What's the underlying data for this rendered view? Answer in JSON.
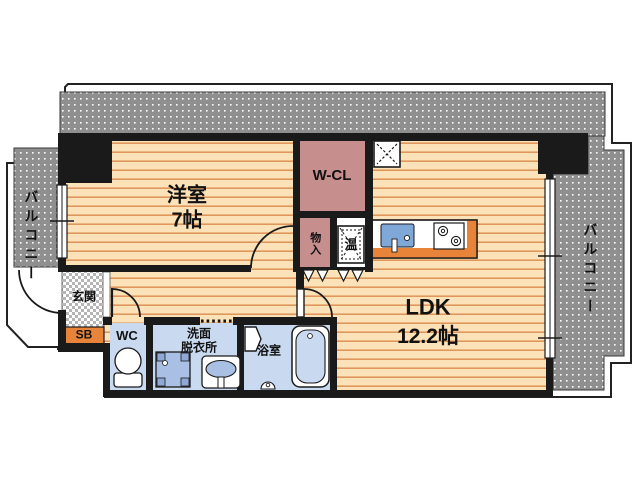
{
  "rooms": {
    "western_room": {
      "name": "洋室",
      "size": "7帖"
    },
    "walk_in_closet": {
      "name": "W-CL"
    },
    "ldk": {
      "name": "LDK",
      "size": "12.2帖"
    },
    "entrance": {
      "name": "玄関"
    },
    "shoe_box": {
      "name": "SB"
    },
    "toilet": {
      "name": "WC"
    },
    "washroom": {
      "line1": "洗面",
      "line2": "脱衣所"
    },
    "bathroom": {
      "name": "浴室"
    },
    "storage": {
      "name": "物入"
    },
    "water_heater": {
      "name": "温"
    },
    "balcony_left": {
      "name": "バルコニー"
    },
    "balcony_right": {
      "name": "バルコニー"
    }
  },
  "colors": {
    "wall": "#1a1a1a",
    "balcony_gray": "#8f8f8f",
    "floor_base": "#fbe2b9",
    "floor_line": "#e0975c",
    "closet_pink": "#c78e8e",
    "wet_room_blue": "#c9d9f0",
    "fixture_blue": "#a9c0e4",
    "accent_orange": "#e8843a",
    "outline_white": "#ffffff"
  }
}
